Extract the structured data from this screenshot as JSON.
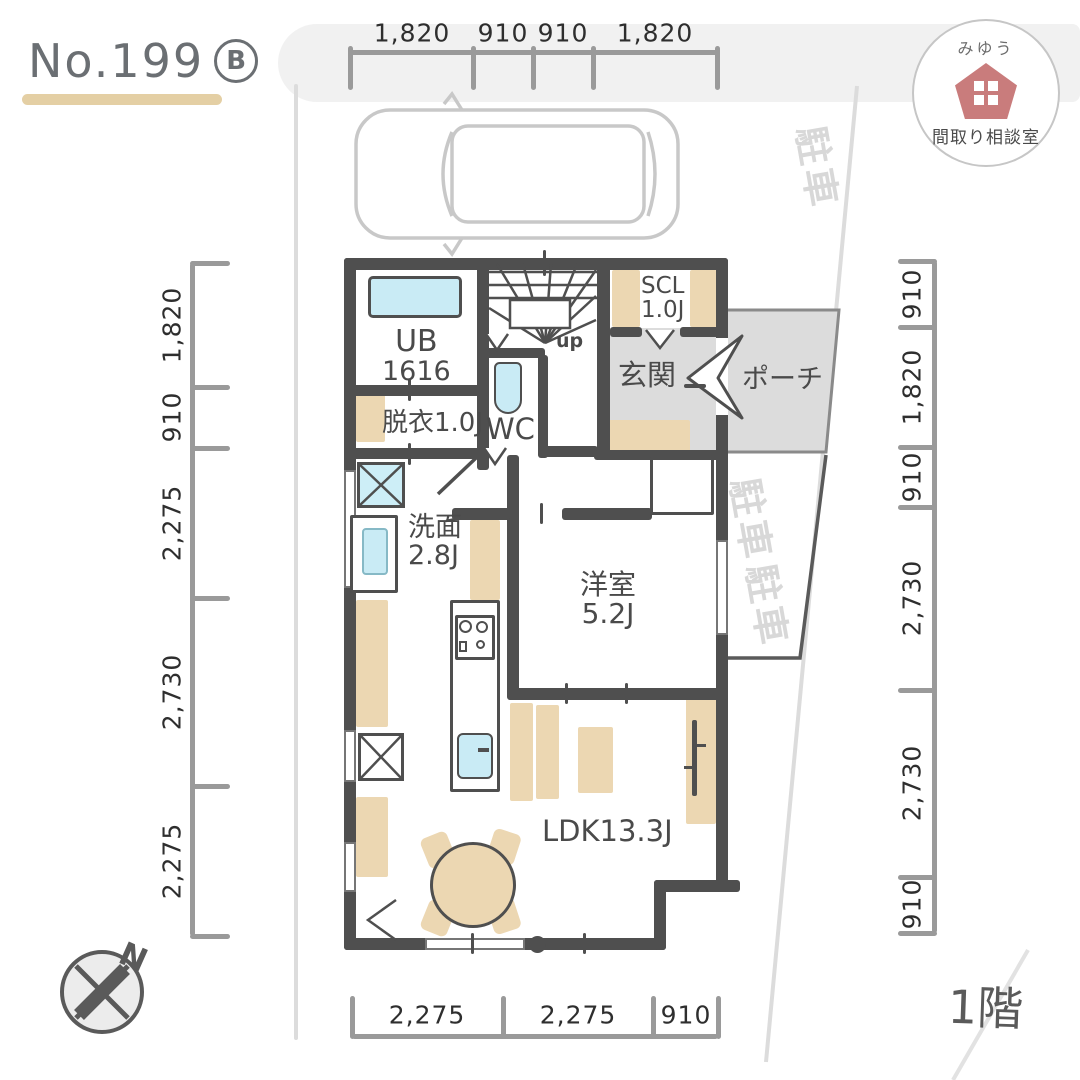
{
  "title": {
    "no": "No.199",
    "variant": "B"
  },
  "logo": {
    "name_top": "みゆう",
    "name_bottom": "間取り相談室"
  },
  "floor_label": "1階",
  "compass_label": "N",
  "stairs": {
    "direction_label": "up"
  },
  "dims": {
    "top": [
      "1,820",
      "910",
      "910",
      "1,820"
    ],
    "left": [
      "1,820",
      "910",
      "2,275",
      "2,730",
      "2,275"
    ],
    "right": [
      "910",
      "1,820",
      "910",
      "2,730",
      "2,730",
      "910"
    ],
    "bottom": [
      "2,275",
      "2,275",
      "910"
    ]
  },
  "rooms": {
    "ub": {
      "name": "UB",
      "size": "1616"
    },
    "datsui": {
      "label": "脱衣1.0J"
    },
    "wc": {
      "label": "WC"
    },
    "scl": {
      "name": "SCL",
      "size": "1.0J"
    },
    "genkan": {
      "label": "玄関"
    },
    "porch": {
      "label": "ポーチ"
    },
    "senmen": {
      "name": "洗面",
      "size": "2.8J"
    },
    "yoshitsu": {
      "name": "洋室",
      "size": "5.2J"
    },
    "ldk": {
      "label": "LDK13.3J"
    }
  },
  "site_scribbles": [
    "駐車",
    "駐車",
    "駐車"
  ],
  "colors": {
    "wall": "#4f4f4f",
    "accent_tan": "#ecd7b2",
    "fixture_blue": "#c9ebf5",
    "entry_gray": "#dcdcdc",
    "logo_pink": "#c97c7c"
  }
}
